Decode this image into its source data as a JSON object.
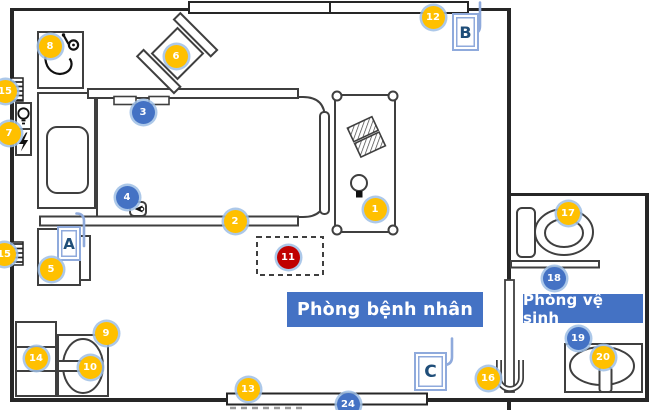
{
  "rooms": {
    "patient_room_label": "Phòng bệnh nhân",
    "bathroom_label": "Phòng vệ sinh"
  },
  "doors": [
    {
      "label": "A"
    },
    {
      "label": "B"
    },
    {
      "label": "C"
    }
  ],
  "markers": [
    {
      "label": "1",
      "type": "yellow",
      "x": 375,
      "y": 209
    },
    {
      "label": "2",
      "type": "yellow",
      "x": 235,
      "y": 221
    },
    {
      "label": "3",
      "type": "blue",
      "x": 143,
      "y": 112
    },
    {
      "label": "4",
      "type": "blue",
      "x": 127,
      "y": 197
    },
    {
      "label": "5",
      "type": "yellow",
      "x": 51,
      "y": 269
    },
    {
      "label": "6",
      "type": "yellow",
      "x": 176,
      "y": 56
    },
    {
      "label": "7",
      "type": "yellow",
      "x": 9,
      "y": 133
    },
    {
      "label": "8",
      "type": "yellow",
      "x": 50,
      "y": 46
    },
    {
      "label": "9",
      "type": "yellow",
      "x": 106,
      "y": 333
    },
    {
      "label": "10",
      "type": "yellow",
      "x": 90,
      "y": 367
    },
    {
      "label": "11",
      "type": "red",
      "x": 288,
      "y": 257
    },
    {
      "label": "12",
      "type": "yellow",
      "x": 433,
      "y": 17
    },
    {
      "label": "13",
      "type": "yellow",
      "x": 248,
      "y": 389
    },
    {
      "label": "14",
      "type": "yellow",
      "x": 36,
      "y": 358
    },
    {
      "label": "15",
      "type": "yellow",
      "x": 5,
      "y": 91
    },
    {
      "label": "15",
      "type": "yellow",
      "x": 4,
      "y": 254
    },
    {
      "label": "16",
      "type": "yellow",
      "x": 488,
      "y": 378
    },
    {
      "label": "17",
      "type": "yellow",
      "x": 568,
      "y": 213
    },
    {
      "label": "18",
      "type": "blue",
      "x": 554,
      "y": 278
    },
    {
      "label": "19",
      "type": "blue",
      "x": 578,
      "y": 338
    },
    {
      "label": "20",
      "type": "yellow",
      "x": 603,
      "y": 357
    },
    {
      "label": "24",
      "type": "blue",
      "x": 348,
      "y": 404
    }
  ],
  "colors": {
    "yellow": "#FFC000",
    "blue": "#4472C4",
    "red": "#C00000",
    "label_bg": "#4472C4",
    "door_blue": "#8FAADC",
    "door_text": "#1F4E79",
    "wall": "#262626",
    "outline": "#3F3F3F"
  },
  "icons": {
    "stethoscope-icon": "stethoscope symbol",
    "lightbulb-icon": "light bulb",
    "lightning-icon": "power bolt",
    "lamp-icon": "bedside lamp",
    "book-icon": "hatched notebook",
    "faucet-icon": "tap",
    "door-swing-icon": "door leaf with swing hook",
    "door-handle-icon": "U-shaped pull handle",
    "vent-icon": "hatched wall grille",
    "nurse-call-icon": "call button"
  }
}
